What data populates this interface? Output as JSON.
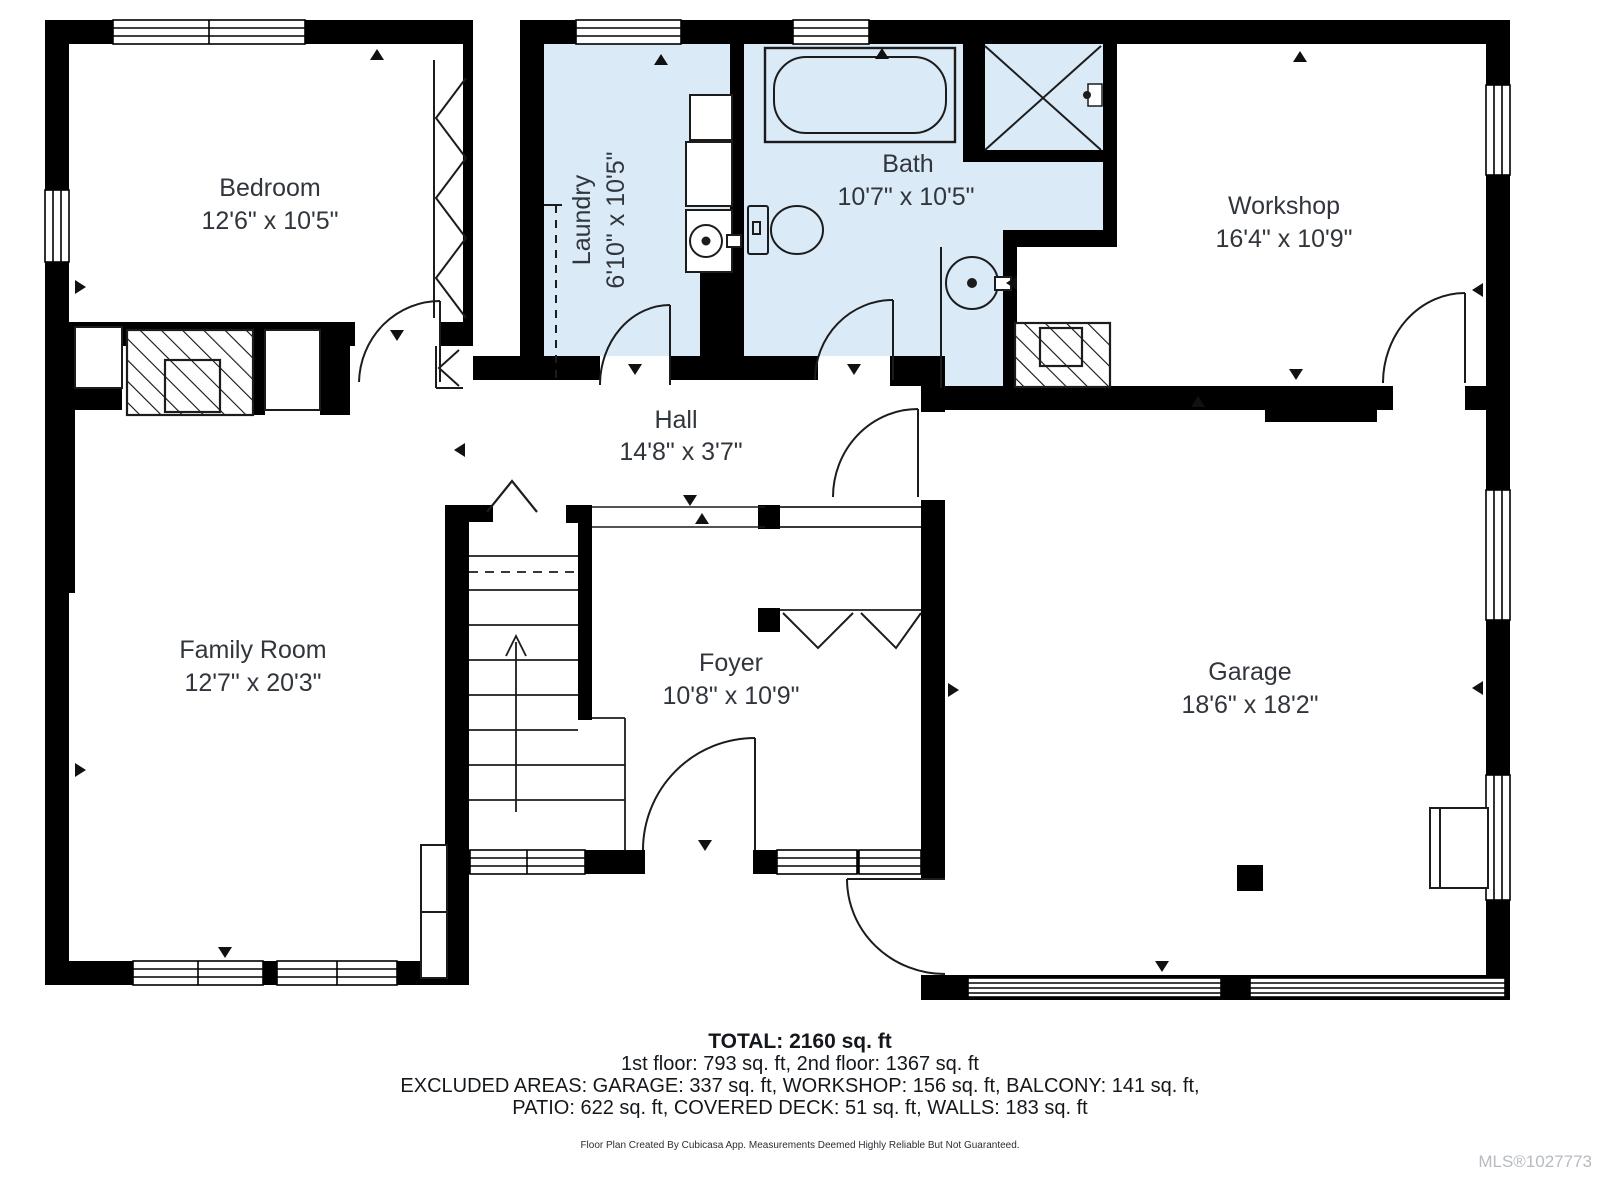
{
  "plan": {
    "rooms": [
      {
        "id": "bedroom",
        "name": "Bedroom",
        "dims": "12'6\" x 10'5\""
      },
      {
        "id": "laundry",
        "name": "Laundry",
        "dims": "6'10\" x 10'5\""
      },
      {
        "id": "bath",
        "name": "Bath",
        "dims": "10'7\" x 10'5\""
      },
      {
        "id": "workshop",
        "name": "Workshop",
        "dims": "16'4\" x 10'9\""
      },
      {
        "id": "hall",
        "name": "Hall",
        "dims": "14'8\" x 3'7\""
      },
      {
        "id": "family_room",
        "name": "Family Room",
        "dims": "12'7\" x 20'3\""
      },
      {
        "id": "foyer",
        "name": "Foyer",
        "dims": "10'8\" x 10'9\""
      },
      {
        "id": "garage",
        "name": "Garage",
        "dims": "18'6\" x 18'2\""
      }
    ],
    "colors": {
      "wall": "#000000",
      "wet_room_fill": "#dbeaf7",
      "room_fill": "#ffffff",
      "label": "#31363c"
    }
  },
  "summary": {
    "total": "TOTAL: 2160 sq. ft",
    "floors": "1st floor: 793 sq. ft, 2nd floor: 1367 sq. ft",
    "excluded_1": "EXCLUDED AREAS: GARAGE: 337 sq. ft, WORKSHOP: 156 sq. ft, BALCONY: 141 sq. ft,",
    "excluded_2": "PATIO: 622 sq. ft, COVERED DECK: 51 sq. ft, WALLS: 183 sq. ft"
  },
  "footer": {
    "disclaimer": "Floor Plan Created By Cubicasa App. Measurements Deemed Highly Reliable But Not Guaranteed.",
    "mls": "MLS®1027773"
  }
}
